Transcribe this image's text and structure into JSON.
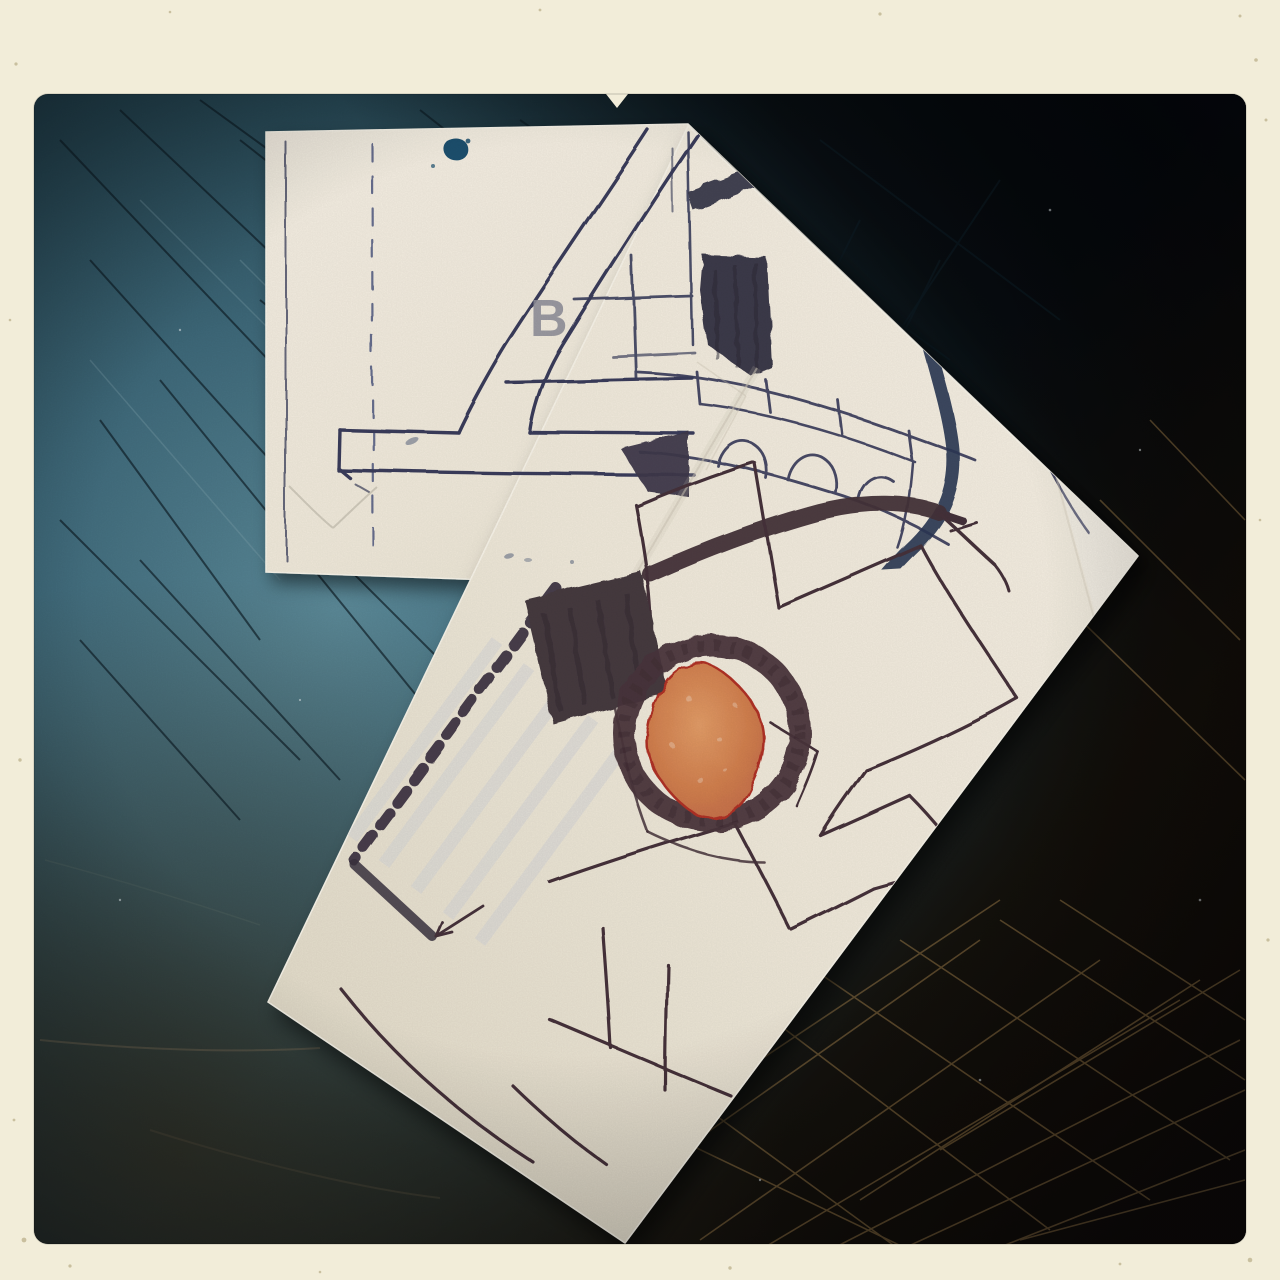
{
  "photo": {
    "type_label": "hand-drawn street maps on paper, photographed on a scratched dark tabletop",
    "frame": {
      "color": "#f2edd9"
    },
    "table": {
      "teal": "#57869a",
      "deep_teal": "#24434f",
      "near_black": "#0b0d10",
      "brown_black": "#150e07",
      "scratch_gold": "#a8854e"
    },
    "back_sheet": {
      "label": "B",
      "label_color": "#90909a",
      "pen_color": "#3a3e5c",
      "thick_road_color": "#2c3a57",
      "marker_patch_color": "#3e3a4b",
      "ink_blob_color": "#1d5170",
      "paper_color": "#f6f0e2"
    },
    "front_sheet": {
      "pen_color": "#46333a",
      "thick_road_color": "#45333a",
      "roundabout_ring_color": "#4b363d",
      "building_fill": "#d98a58",
      "building_outline": "#b23227",
      "dark_building_color": "#463a41",
      "paper_color": "#f7f1e3"
    }
  }
}
